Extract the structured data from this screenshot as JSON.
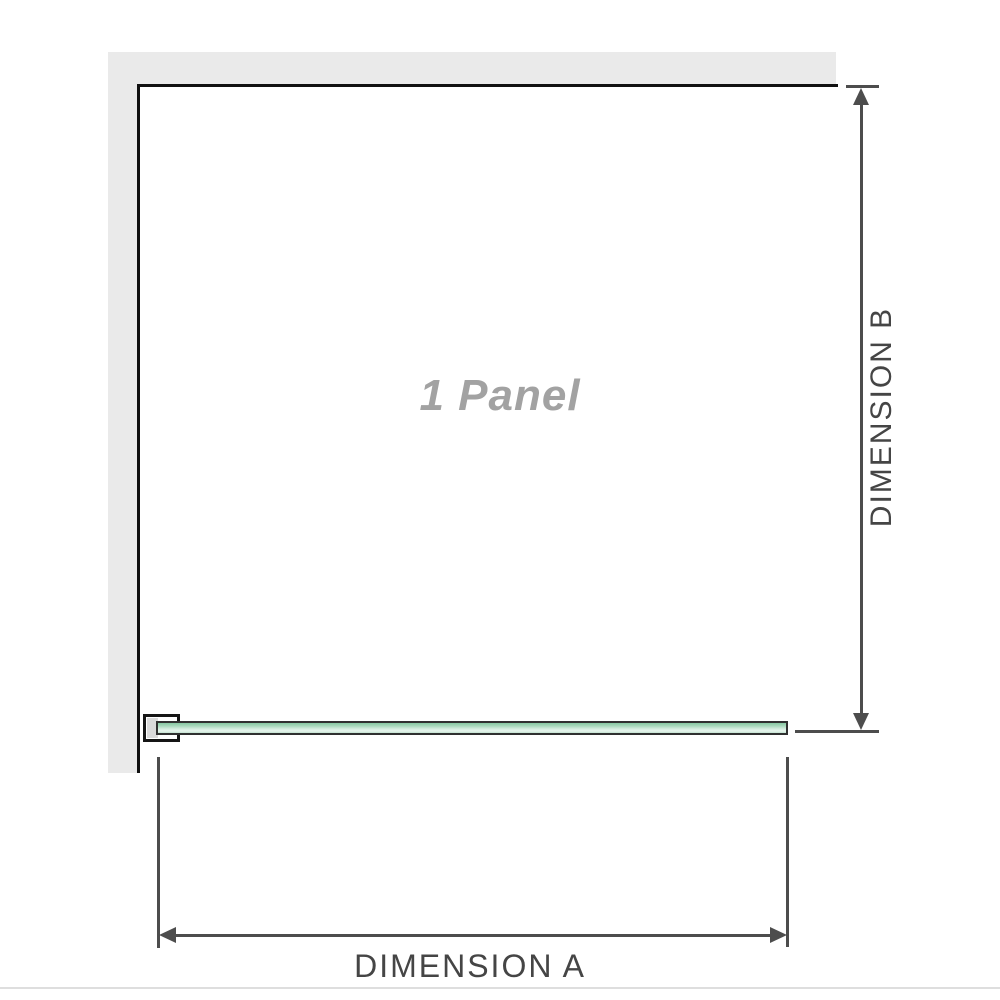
{
  "diagram": {
    "title": "1 Panel",
    "type_note": "shower screen plan view, single fixed panel",
    "dimensions": {
      "a_label": "DIMENSION A",
      "b_label": "DIMENSION B"
    }
  },
  "colors": {
    "background": "#ffffff",
    "wall_fill": "#eaeaea",
    "wall_edge": "#111111",
    "glass_green_dark": "#86c7a1",
    "glass_green_light": "#e7f5ed",
    "glass_outline": "#303030",
    "bracket_outline": "#151515",
    "bracket_pad": "#dadada",
    "dimension_line": "#4d4d4d",
    "dimension_text": "#454545",
    "panel_text": "#a2a2a2",
    "bottom_divider": "#dedede"
  }
}
